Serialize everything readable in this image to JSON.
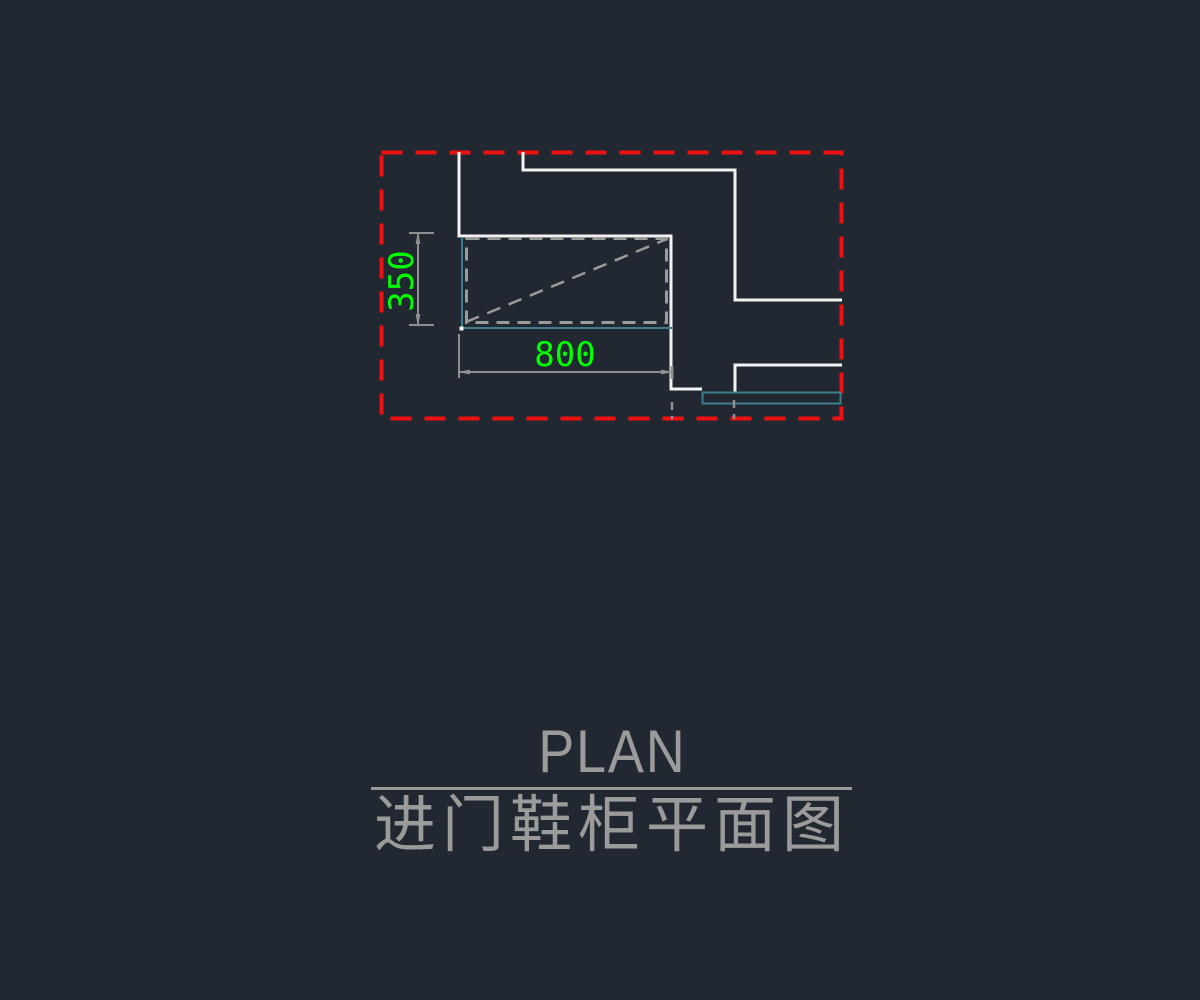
{
  "view": {
    "type": "cad-plan-drawing",
    "background": "#222831"
  },
  "colors": {
    "background": "#222831",
    "crop-red": "#ed1111",
    "wall-white": "#f2f2f2",
    "cabinet-gray": "#9a9a9a",
    "dim-gray": "#8f8f8f",
    "dim-text-green": "#00ff00",
    "threshold-cyan": "#3d7e8c",
    "title-gray": "#9b9b9b"
  },
  "drawing": {
    "description": "entry shoe cabinet plan view inside red dashed crop boundary",
    "dim_depth_label": "350",
    "dim_width_label": "800"
  },
  "title": {
    "primary": "PLAN",
    "secondary": "进门鞋柜平面图"
  }
}
